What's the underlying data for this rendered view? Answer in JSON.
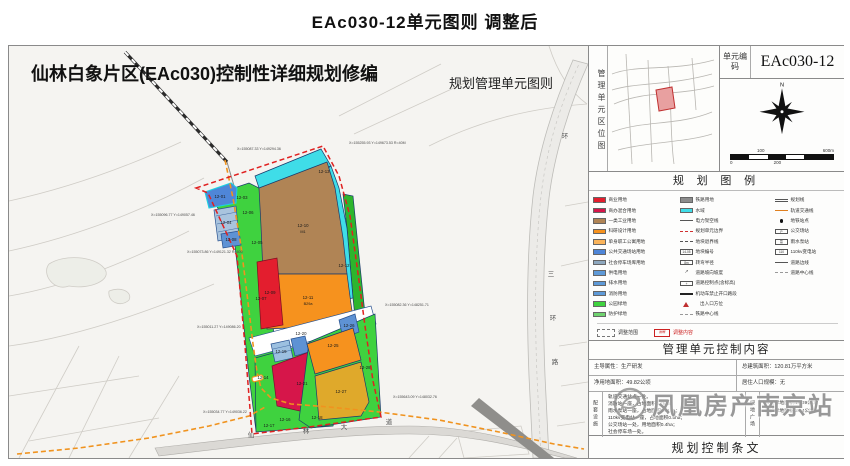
{
  "page": {
    "title": "EAc030-12单元图则  调整后"
  },
  "sheet": {
    "title": "仙林白象片区(EAc030)控制性详细规划修编",
    "subtitle": "规划管理单元图则"
  },
  "map": {
    "road_labels": {
      "xianlin": [
        "仙",
        "林",
        "大",
        "道"
      ],
      "sanhuan": [
        "三",
        "环",
        "路"
      ],
      "huan": "环"
    },
    "parcels": [
      {
        "id": "12-01",
        "code": ""
      },
      {
        "id": "12-03",
        "code": ""
      },
      {
        "id": "12-04",
        "code": ""
      },
      {
        "id": "12-05",
        "code": ""
      },
      {
        "id": "12-06",
        "code": ""
      },
      {
        "id": "12-07",
        "code": ""
      },
      {
        "id": "12-08",
        "code": ""
      },
      {
        "id": "12-09",
        "code": ""
      },
      {
        "id": "12-10",
        "code": "M1"
      },
      {
        "id": "12-11",
        "code": "B29a"
      },
      {
        "id": "12-12",
        "code": ""
      },
      {
        "id": "12-13",
        "code": ""
      },
      {
        "id": "12-14",
        "code": ""
      },
      {
        "id": "12-16",
        "code": ""
      },
      {
        "id": "12-17",
        "code": "E1"
      },
      {
        "id": "12-18",
        "code": ""
      },
      {
        "id": "12-19",
        "code": "S41"
      },
      {
        "id": "12-20",
        "code": ""
      },
      {
        "id": "12-21",
        "code": ""
      },
      {
        "id": "12-25",
        "code": "B29a"
      },
      {
        "id": "12-26",
        "code": ""
      },
      {
        "id": "12-27",
        "code": ""
      },
      {
        "id": "12-28",
        "code": ""
      }
    ],
    "coords": [
      {
        "text": "X=155087.33 Y=149294.36"
      },
      {
        "text": "X=155255.93 Y=149673.53 R=40M"
      },
      {
        "text": "X=155096.77 Y=149057.46"
      },
      {
        "text": "X=155073.86 Y=149121.32 R=600"
      },
      {
        "text": "X=155011.27 Y=149086.20"
      },
      {
        "text": "X=155034.77 Y=149036.22"
      },
      {
        "text": "X=155082.36 Y=148251.71"
      },
      {
        "text": "X=155643.09 Y=148032.76"
      }
    ]
  },
  "panel": {
    "location": {
      "label": "管理单元区位图"
    },
    "unit_code": {
      "label": "单元编码",
      "value": "EAc030-12"
    },
    "compass": {
      "north": "N"
    },
    "scalebar": {
      "top_left": "100",
      "top_right": "600m",
      "bottom_left": "0",
      "bottom_mid": "200"
    },
    "legend": {
      "title": "规 划 图 例",
      "col1": [
        {
          "label": "商业用地",
          "color": "#e31e2e"
        },
        {
          "label": "商办混合用地",
          "color": "#d6164a"
        },
        {
          "label": "一类工业用地",
          "color": "#b08455"
        },
        {
          "label": "科研设计用地",
          "color": "#f6921e"
        },
        {
          "label": "单身职工公寓用地",
          "color": "#f9b35a"
        },
        {
          "label": "公共交通场站用地",
          "color": "#4f86d8"
        },
        {
          "label": "社会停车场库用地",
          "color": "#8ea8bf"
        },
        {
          "label": "供电用地",
          "color": "#5e9ad8"
        },
        {
          "label": "排水用地",
          "color": "#5e9ad8"
        },
        {
          "label": "消防用地",
          "color": "#5e9ad8"
        },
        {
          "label": "公园绿地",
          "color": "#3fd23f"
        },
        {
          "label": "防护绿地",
          "color": "#6fd36f"
        }
      ],
      "col2": [
        {
          "label": "铁路用地",
          "color": "#8c8c8c"
        },
        {
          "label": "水域",
          "color": "#3fdde8"
        },
        {
          "label": "电力架空线"
        },
        {
          "label": "规划单元边界"
        },
        {
          "label": "地块退界线"
        },
        {
          "label": "地块编号",
          "glyph": "14-05"
        },
        {
          "label": "转弯半径",
          "glyph": "8m"
        },
        {
          "label": "道路坡向坡度",
          "glyph": "↗"
        },
        {
          "label": "道路控制点(含标高)",
          "glyph": "+"
        },
        {
          "label": "机动车禁止开口路段"
        },
        {
          "label": "出入口方位"
        },
        {
          "label": "铁路中心线"
        }
      ],
      "col3": [
        {
          "label": "规划线"
        },
        {
          "label": "轨道交通线"
        },
        {
          "label": "地铁站点"
        },
        {
          "label": "公交场站",
          "glyph": "P"
        },
        {
          "label": "雨水泵站",
          "glyph": "泵"
        },
        {
          "label": "110kv变电站",
          "glyph": "110"
        },
        {
          "label": "道路边线"
        },
        {
          "label": "道路中心线"
        }
      ],
      "adjust": [
        {
          "label": "调整范围"
        },
        {
          "label": "调整内容",
          "glyph": "图框"
        }
      ]
    },
    "control": {
      "title": "管理单元控制内容",
      "cells": [
        "主导属性：生产研发",
        "总建筑面积：120.81万平方米",
        "净用地面积：49.82公顷",
        "居住人口规模：无"
      ],
      "facilities": {
        "label": "配套设施",
        "lines": [
          "轨道交通站点一处。",
          "消防站一座，占地面积0.75ha；",
          "雨水泵站一座，占地面积0.21ha；",
          "110kv变电站一座，占地面积0.5ha；",
          "公交场站一处，用地面积0.4ha；",
          "社会停车场一处。"
        ]
      },
      "green": {
        "label": "绿地广场",
        "lines": [
          "公园绿地面积:16.39公顷,",
          "防护绿地面积:2.64公顷。"
        ]
      }
    },
    "terms": {
      "title": "规划控制条文"
    }
  },
  "watermark": {
    "text": "凤凰房产南京站"
  },
  "colors": {
    "boundary_red": "#e02020",
    "metro_orange": "#f0931f",
    "industrial_brown": "#b08455",
    "rnd_orange": "#f6921e",
    "commercial_red": "#e31e2e",
    "mixed_crimson": "#d6164a",
    "green": "#3fd23f",
    "water_cyan": "#3fdde8",
    "transit_blue": "#5e92d4",
    "residential_yellow": "#dfa92b"
  }
}
